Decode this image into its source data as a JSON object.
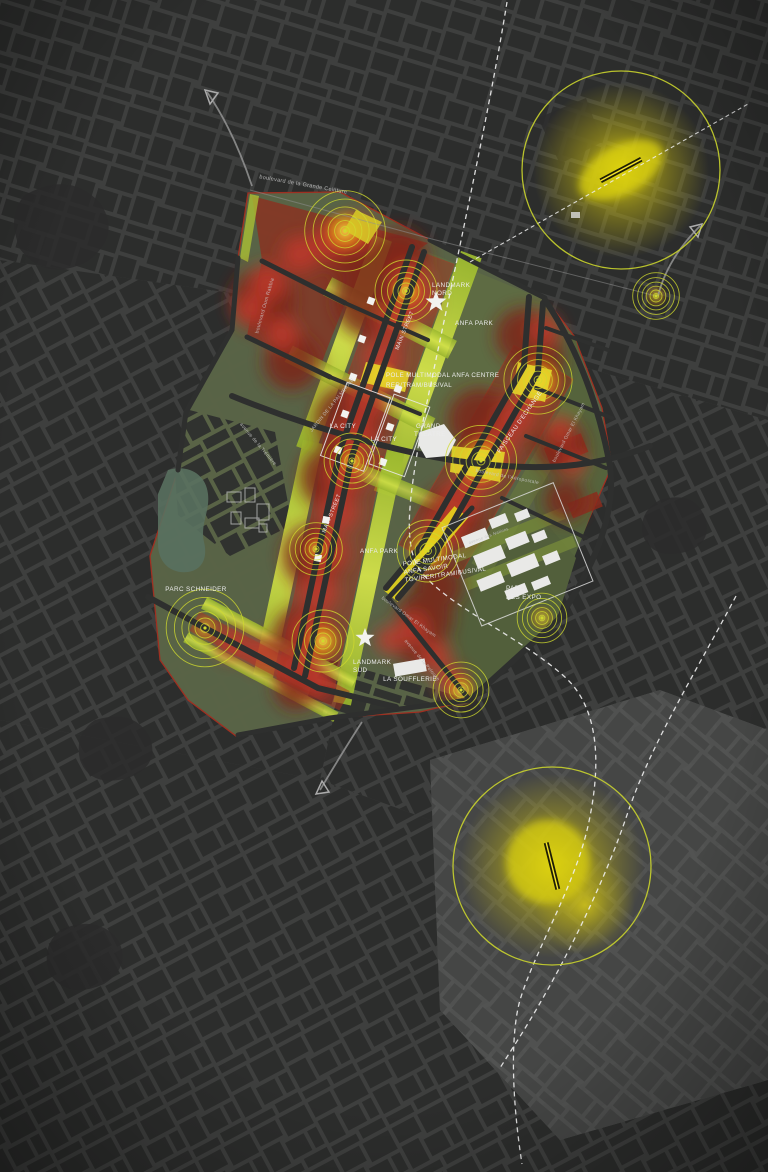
{
  "map": {
    "title": "Plan d'intensité — Casablanca Anfa",
    "colors": {
      "background": "#3e3f3e",
      "city_block": "#2c2d2c",
      "site_olive": "#5a6547",
      "park_lime": "#bcd23a",
      "heat_red": "#c2392b",
      "heat_maroon": "#7c241a",
      "heat_yellow": "#f0d916",
      "ring": "#cfd92e",
      "focus_circle": "#c9d32c",
      "label_white": "#ececec",
      "street_gray": "#c9c9c9",
      "dashed_line": "#f0f0f0"
    },
    "labels": [
      {
        "t": "boulevard de la Grande Ceinture",
        "x": 303,
        "y": 186,
        "r": 10,
        "s": 5.5,
        "c": "street",
        "a": "m"
      },
      {
        "t": "boulevard Oum Rabbia",
        "x": 266,
        "y": 306,
        "r": -74,
        "s": 5,
        "c": "street",
        "a": "m"
      },
      {
        "t": "LANDMARK",
        "x": 432,
        "y": 287,
        "r": 0,
        "s": 6.3,
        "c": "place",
        "a": "s"
      },
      {
        "t": "NORD",
        "x": 432,
        "y": 295,
        "r": 0,
        "s": 6.3,
        "c": "place",
        "a": "s"
      },
      {
        "t": "ANFA PARK",
        "x": 455,
        "y": 325,
        "r": 0,
        "s": 6.3,
        "c": "place",
        "a": "s"
      },
      {
        "t": "MAIN STREET",
        "x": 406,
        "y": 331,
        "r": -68,
        "s": 5.5,
        "c": "place",
        "a": "m"
      },
      {
        "t": "POLE MULTIMODAL ANFA CENTRE",
        "x": 386,
        "y": 377,
        "r": 0,
        "s": 6.2,
        "c": "place",
        "a": "s"
      },
      {
        "t": "RER/TRAM/BUS/VAL",
        "x": 386,
        "y": 387,
        "r": 0,
        "s": 6.2,
        "c": "place",
        "a": "s"
      },
      {
        "t": "JARDIN DE LA PALMERAIE",
        "x": 333,
        "y": 406,
        "r": -51,
        "s": 4.8,
        "c": "street",
        "a": "m"
      },
      {
        "t": "LA CITY",
        "x": 343,
        "y": 428,
        "r": 0,
        "s": 6.3,
        "c": "place",
        "a": "m"
      },
      {
        "t": "LA CITY",
        "x": 384,
        "y": 441,
        "r": 0,
        "s": 6.3,
        "c": "place",
        "a": "m"
      },
      {
        "t": "GRAND",
        "x": 416,
        "y": 428,
        "r": 0,
        "s": 6.3,
        "c": "place",
        "a": "s"
      },
      {
        "t": "THEATRE",
        "x": 414,
        "y": 436,
        "r": 0,
        "s": 6.3,
        "c": "place",
        "a": "s"
      },
      {
        "t": "FAISCEAU D'ECHANGE",
        "x": 521,
        "y": 423,
        "r": -55,
        "s": 6,
        "c": "place",
        "a": "m"
      },
      {
        "t": "boulevard Omar El Khayam",
        "x": 570,
        "y": 433,
        "r": -63,
        "s": 4.8,
        "c": "street",
        "a": "m"
      },
      {
        "t": "boulevard de l'Aéropostale",
        "x": 507,
        "y": 478,
        "r": 11,
        "s": 4.8,
        "c": "street",
        "a": "m"
      },
      {
        "t": "MAIN STREET",
        "x": 333,
        "y": 514,
        "r": -68,
        "s": 5.5,
        "c": "place",
        "a": "m"
      },
      {
        "t": "ANFA PARK",
        "x": 360,
        "y": 553,
        "r": 0,
        "s": 6.3,
        "c": "place",
        "a": "s"
      },
      {
        "t": "avenue des Nations",
        "x": 489,
        "y": 537,
        "r": -20,
        "s": 4.2,
        "c": "street",
        "a": "m"
      },
      {
        "t": "POLE MULTIMODAL",
        "x": 403,
        "y": 566,
        "r": -8,
        "s": 6.2,
        "c": "place",
        "a": "s"
      },
      {
        "t": "ANFA SAVOIR",
        "x": 404,
        "y": 574,
        "r": -8,
        "s": 6.2,
        "c": "place",
        "a": "s"
      },
      {
        "t": "TGV/RER/TRAM/BUS/VAL",
        "x": 405,
        "y": 582,
        "r": -8,
        "s": 6.2,
        "c": "place",
        "a": "s"
      },
      {
        "t": "PARC",
        "x": 506,
        "y": 590,
        "r": 0,
        "s": 6.3,
        "c": "place",
        "a": "s"
      },
      {
        "t": "DES EXPO",
        "x": 506,
        "y": 599,
        "r": 0,
        "s": 6.3,
        "c": "place",
        "a": "s"
      },
      {
        "t": "PARC SCHNEIDER",
        "x": 196,
        "y": 591,
        "r": 0,
        "s": 6.3,
        "c": "place",
        "a": "m"
      },
      {
        "t": "LANDMARK",
        "x": 353,
        "y": 664,
        "r": 0,
        "s": 6.3,
        "c": "place",
        "a": "s"
      },
      {
        "t": "SUD",
        "x": 353,
        "y": 672,
        "r": 0,
        "s": 6.3,
        "c": "place",
        "a": "s"
      },
      {
        "t": "LA SOUFFLERIE",
        "x": 410,
        "y": 681,
        "r": 0,
        "s": 6.3,
        "c": "place",
        "a": "m"
      },
      {
        "t": "boulevard Omar El Khayam",
        "x": 408,
        "y": 618,
        "r": 36,
        "s": 4.8,
        "c": "street",
        "a": "m"
      },
      {
        "t": "avenue de la Pelouse",
        "x": 421,
        "y": 661,
        "r": 50,
        "s": 4.8,
        "c": "street",
        "a": "m"
      },
      {
        "t": "avenue de la Trémière",
        "x": 257,
        "y": 445,
        "r": 50,
        "s": 4.8,
        "c": "street",
        "a": "m"
      }
    ],
    "attention_nodes": [
      {
        "x": 345,
        "y": 231,
        "scale": 1.3
      },
      {
        "x": 406,
        "y": 291,
        "scale": 1.0
      },
      {
        "x": 538,
        "y": 380,
        "scale": 1.1
      },
      {
        "x": 656,
        "y": 296,
        "scale": 0.75
      },
      {
        "x": 352,
        "y": 461,
        "scale": 0.9
      },
      {
        "x": 481,
        "y": 461,
        "scale": 1.15
      },
      {
        "x": 316,
        "y": 549,
        "scale": 0.85
      },
      {
        "x": 428,
        "y": 551,
        "scale": 1.0
      },
      {
        "x": 205,
        "y": 628,
        "scale": 1.25
      },
      {
        "x": 323,
        "y": 641,
        "scale": 1.0
      },
      {
        "x": 461,
        "y": 690,
        "scale": 0.9
      },
      {
        "x": 542,
        "y": 618,
        "scale": 0.8
      }
    ],
    "focus_circles": [
      {
        "x": 621,
        "y": 170,
        "r": 99
      },
      {
        "x": 552,
        "y": 866,
        "r": 99
      }
    ],
    "rail_segments": [
      {
        "x": 621,
        "y": 170,
        "angle": -28,
        "len": 46
      },
      {
        "x": 552,
        "y": 866,
        "angle": 76,
        "len": 48
      }
    ],
    "landmark_stars": [
      {
        "x": 436,
        "y": 302,
        "r": 11
      },
      {
        "x": 365,
        "y": 638,
        "r": 10
      }
    ],
    "stations": [
      {
        "x": 371,
        "y": 301,
        "rot": 20
      },
      {
        "x": 362,
        "y": 339,
        "rot": 20
      },
      {
        "x": 353,
        "y": 377,
        "rot": 20
      },
      {
        "x": 345,
        "y": 414,
        "rot": 20
      },
      {
        "x": 338,
        "y": 450,
        "rot": 20
      },
      {
        "x": 398,
        "y": 389,
        "rot": 20
      },
      {
        "x": 390,
        "y": 427,
        "rot": 20
      },
      {
        "x": 383,
        "y": 462,
        "rot": 20
      },
      {
        "x": 326,
        "y": 520,
        "rot": 12
      },
      {
        "x": 318,
        "y": 558,
        "rot": 12
      }
    ]
  }
}
